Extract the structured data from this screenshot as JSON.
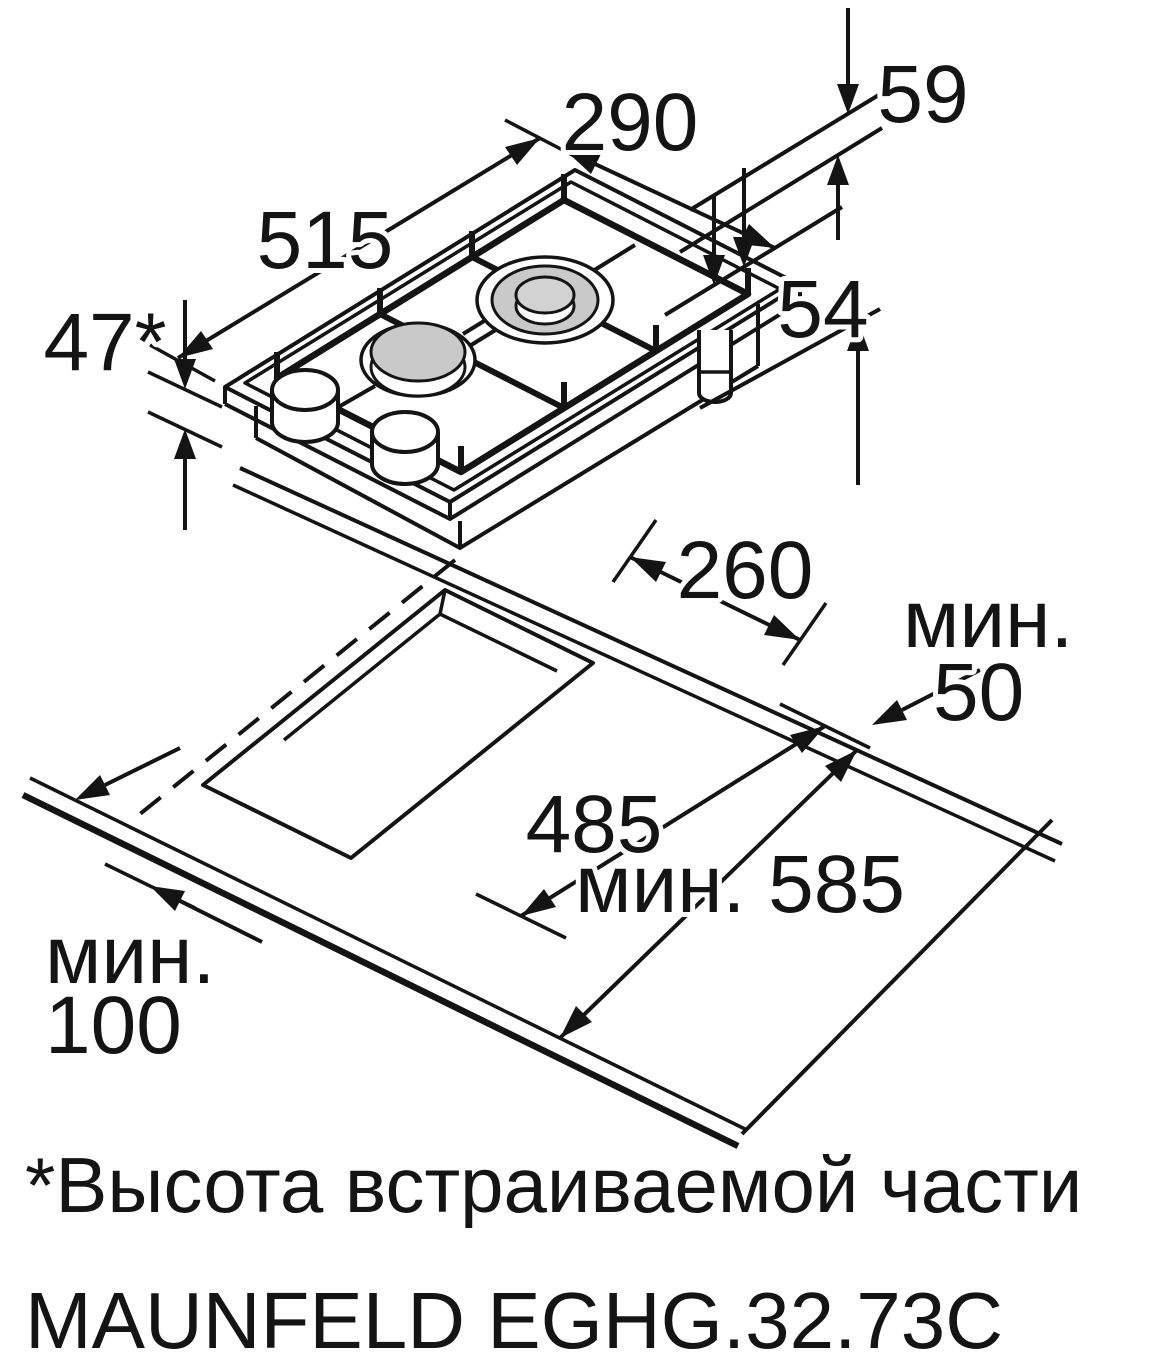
{
  "colors": {
    "background": "#ffffff",
    "line": "#141414",
    "burner_gray": "#c9c9c9",
    "burner_cap_gray": "#d2d2d2"
  },
  "hob_view": {
    "width_mm": "290",
    "depth_mm": "515",
    "grate_height_mm": "59",
    "body_height_mm": "54",
    "builtin_height_mm": "47*"
  },
  "cutout_view": {
    "cutout_width_mm": "260",
    "min_back_label": "мин.",
    "min_back_mm": "50",
    "cutout_depth_mm": "485",
    "min_worktop_depth_label": "мин. 585",
    "min_front_label": "мин.",
    "min_front_mm": "100"
  },
  "footnote": "*Высота встраиваемой части",
  "model_name": "MAUNFELD EGHG.32.73C"
}
